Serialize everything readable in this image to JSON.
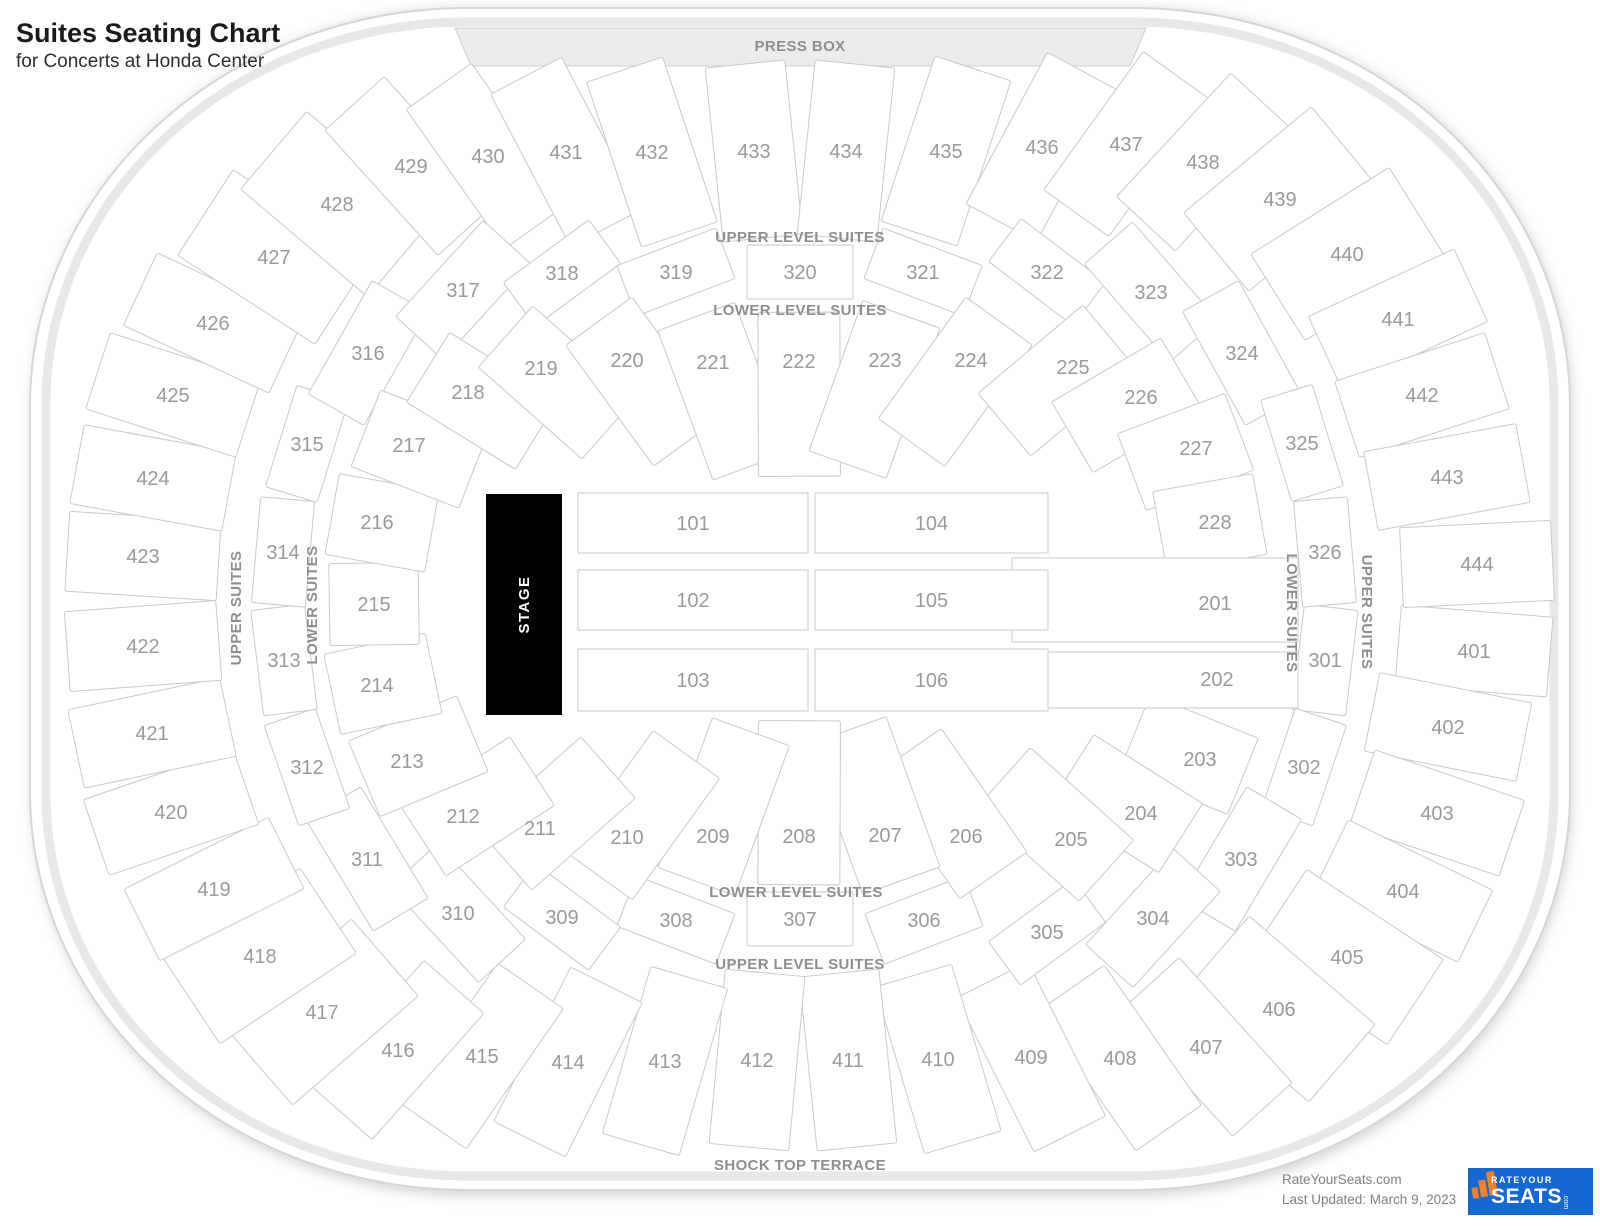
{
  "title": {
    "heading": "Suites Seating Chart",
    "subheading": "for Concerts at Honda Center"
  },
  "credits": {
    "site": "RateYourSeats.com",
    "updated": "Last Updated: March 9, 2023"
  },
  "logo": {
    "line1": "RATEYOUR",
    "line2": "SEATS",
    "suffix": ".com"
  },
  "colors": {
    "section_fill": "#ffffff",
    "section_border": "#c9c9c9",
    "number_text": "#9a9a9a",
    "ring_label_text": "#8e8e8e",
    "press_box_fill": "#ececec",
    "stage_fill": "#000000",
    "stage_text": "#ffffff",
    "logo_blue": "#1567d2",
    "logo_orange": "#f58025",
    "outer_rim": "#e3e3e3"
  },
  "arena": {
    "center": {
      "x": 800,
      "y": 597
    },
    "press_box": {
      "label": "PRESS BOX",
      "x": 800,
      "y": 51
    },
    "stage": {
      "label": "STAGE",
      "x": 486,
      "y": 494,
      "w": 76,
      "h": 221
    },
    "ring_labels": [
      {
        "name": "upper-level-suites-top",
        "text": "UPPER LEVEL SUITES",
        "x": 800,
        "y": 242,
        "rot": 0
      },
      {
        "name": "lower-level-suites-top",
        "text": "LOWER LEVEL SUITES",
        "x": 800,
        "y": 315,
        "rot": 0
      },
      {
        "name": "lower-level-suites-bottom",
        "text": "LOWER LEVEL SUITES",
        "x": 796,
        "y": 897,
        "rot": 0
      },
      {
        "name": "upper-level-suites-bottom",
        "text": "UPPER LEVEL SUITES",
        "x": 800,
        "y": 969,
        "rot": 0
      },
      {
        "name": "shock-top-terrace",
        "text": "SHOCK TOP TERRACE",
        "x": 800,
        "y": 1170,
        "rot": 0
      },
      {
        "name": "upper-suites-left",
        "text": "UPPER SUITES",
        "x": 241,
        "y": 608,
        "rot": -90
      },
      {
        "name": "lower-suites-left",
        "text": "LOWER SUITES",
        "x": 317,
        "y": 605,
        "rot": -90
      },
      {
        "name": "lower-suites-right",
        "text": "LOWER SUITES",
        "x": 1287,
        "y": 613,
        "rot": 90
      },
      {
        "name": "upper-suites-right",
        "text": "UPPER SUITES",
        "x": 1362,
        "y": 612,
        "rot": 90
      }
    ],
    "floor_sections": [
      {
        "id": "101",
        "x": 578,
        "y": 493,
        "w": 230,
        "h": 60
      },
      {
        "id": "102",
        "x": 578,
        "y": 570,
        "w": 230,
        "h": 60
      },
      {
        "id": "103",
        "x": 578,
        "y": 649,
        "w": 230,
        "h": 62
      },
      {
        "id": "104",
        "x": 815,
        "y": 493,
        "w": 233,
        "h": 60
      },
      {
        "id": "105",
        "x": 815,
        "y": 570,
        "w": 233,
        "h": 60
      },
      {
        "id": "106",
        "x": 815,
        "y": 649,
        "w": 233,
        "h": 62
      }
    ],
    "special_sections": [
      {
        "id": "201",
        "x": 1012,
        "y": 558,
        "w": 286,
        "h": 84,
        "lx": 1215,
        "ly": 603
      },
      {
        "id": "202",
        "x": 1040,
        "y": 652,
        "w": 258,
        "h": 56,
        "lx": 1217,
        "ly": 679
      }
    ],
    "rings": {
      "inner": {
        "sections": [
          {
            "id": "203",
            "x": 1200,
            "y": 759
          },
          {
            "id": "204",
            "x": 1141,
            "y": 813
          },
          {
            "id": "205",
            "x": 1071,
            "y": 839
          },
          {
            "id": "206",
            "x": 966,
            "y": 836
          },
          {
            "id": "207",
            "x": 885,
            "y": 835
          },
          {
            "id": "208",
            "x": 799,
            "y": 836
          },
          {
            "id": "209",
            "x": 713,
            "y": 836
          },
          {
            "id": "210",
            "x": 627,
            "y": 837
          },
          {
            "id": "211",
            "x": 540,
            "y": 828
          },
          {
            "id": "212",
            "x": 463,
            "y": 816
          },
          {
            "id": "213",
            "x": 407,
            "y": 761
          },
          {
            "id": "214",
            "x": 377,
            "y": 685
          },
          {
            "id": "215",
            "x": 374,
            "y": 604
          },
          {
            "id": "216",
            "x": 377,
            "y": 522
          },
          {
            "id": "217",
            "x": 409,
            "y": 445
          },
          {
            "id": "218",
            "x": 468,
            "y": 392
          },
          {
            "id": "219",
            "x": 541,
            "y": 368
          },
          {
            "id": "220",
            "x": 627,
            "y": 360
          },
          {
            "id": "221",
            "x": 713,
            "y": 362
          },
          {
            "id": "222",
            "x": 799,
            "y": 361
          },
          {
            "id": "223",
            "x": 885,
            "y": 360
          },
          {
            "id": "224",
            "x": 971,
            "y": 360
          },
          {
            "id": "225",
            "x": 1073,
            "y": 367
          },
          {
            "id": "226",
            "x": 1141,
            "y": 397
          },
          {
            "id": "227",
            "x": 1196,
            "y": 448
          },
          {
            "id": "228",
            "x": 1215,
            "y": 522
          }
        ]
      },
      "middle": {
        "corners": [
          "303",
          "304",
          "310",
          "311",
          "316",
          "317",
          "323",
          "324"
        ],
        "sections": [
          {
            "id": "301",
            "x": 1325,
            "y": 660
          },
          {
            "id": "302",
            "x": 1304,
            "y": 767
          },
          {
            "id": "303",
            "x": 1241,
            "y": 859
          },
          {
            "id": "304",
            "x": 1153,
            "y": 918
          },
          {
            "id": "305",
            "x": 1047,
            "y": 932
          },
          {
            "id": "306",
            "x": 924,
            "y": 920
          },
          {
            "id": "307",
            "x": 800,
            "y": 919
          },
          {
            "id": "308",
            "x": 676,
            "y": 920
          },
          {
            "id": "309",
            "x": 562,
            "y": 917
          },
          {
            "id": "310",
            "x": 458,
            "y": 913
          },
          {
            "id": "311",
            "x": 367,
            "y": 859
          },
          {
            "id": "312",
            "x": 307,
            "y": 767
          },
          {
            "id": "313",
            "x": 284,
            "y": 660
          },
          {
            "id": "314",
            "x": 283,
            "y": 552
          },
          {
            "id": "315",
            "x": 307,
            "y": 444
          },
          {
            "id": "316",
            "x": 368,
            "y": 353
          },
          {
            "id": "317",
            "x": 463,
            "y": 290
          },
          {
            "id": "318",
            "x": 562,
            "y": 273
          },
          {
            "id": "319",
            "x": 676,
            "y": 272
          },
          {
            "id": "320",
            "x": 800,
            "y": 272
          },
          {
            "id": "321",
            "x": 923,
            "y": 272
          },
          {
            "id": "322",
            "x": 1047,
            "y": 272
          },
          {
            "id": "323",
            "x": 1151,
            "y": 292
          },
          {
            "id": "324",
            "x": 1242,
            "y": 353
          },
          {
            "id": "325",
            "x": 1302,
            "y": 443
          },
          {
            "id": "326",
            "x": 1325,
            "y": 552
          }
        ]
      },
      "outer": {
        "corners": [
          "405",
          "406",
          "417",
          "418",
          "427",
          "428",
          "439",
          "440"
        ],
        "sections": [
          {
            "id": "401",
            "x": 1474,
            "y": 651
          },
          {
            "id": "402",
            "x": 1448,
            "y": 727
          },
          {
            "id": "403",
            "x": 1437,
            "y": 813
          },
          {
            "id": "404",
            "x": 1403,
            "y": 891
          },
          {
            "id": "405",
            "x": 1347,
            "y": 957
          },
          {
            "id": "406",
            "x": 1279,
            "y": 1009
          },
          {
            "id": "407",
            "x": 1206,
            "y": 1047
          },
          {
            "id": "408",
            "x": 1120,
            "y": 1058
          },
          {
            "id": "409",
            "x": 1031,
            "y": 1057
          },
          {
            "id": "410",
            "x": 938,
            "y": 1059
          },
          {
            "id": "411",
            "x": 848,
            "y": 1060
          },
          {
            "id": "412",
            "x": 757,
            "y": 1060
          },
          {
            "id": "413",
            "x": 665,
            "y": 1061
          },
          {
            "id": "414",
            "x": 568,
            "y": 1062
          },
          {
            "id": "415",
            "x": 482,
            "y": 1056
          },
          {
            "id": "416",
            "x": 398,
            "y": 1050
          },
          {
            "id": "417",
            "x": 322,
            "y": 1012
          },
          {
            "id": "418",
            "x": 260,
            "y": 956
          },
          {
            "id": "419",
            "x": 214,
            "y": 889
          },
          {
            "id": "420",
            "x": 171,
            "y": 812
          },
          {
            "id": "421",
            "x": 152,
            "y": 733
          },
          {
            "id": "422",
            "x": 143,
            "y": 646
          },
          {
            "id": "423",
            "x": 143,
            "y": 556
          },
          {
            "id": "424",
            "x": 153,
            "y": 478
          },
          {
            "id": "425",
            "x": 173,
            "y": 395
          },
          {
            "id": "426",
            "x": 213,
            "y": 323
          },
          {
            "id": "427",
            "x": 274,
            "y": 257
          },
          {
            "id": "428",
            "x": 337,
            "y": 204
          },
          {
            "id": "429",
            "x": 411,
            "y": 166
          },
          {
            "id": "430",
            "x": 488,
            "y": 156
          },
          {
            "id": "431",
            "x": 566,
            "y": 152
          },
          {
            "id": "432",
            "x": 652,
            "y": 152
          },
          {
            "id": "433",
            "x": 754,
            "y": 151
          },
          {
            "id": "434",
            "x": 846,
            "y": 151
          },
          {
            "id": "435",
            "x": 946,
            "y": 151
          },
          {
            "id": "436",
            "x": 1042,
            "y": 147
          },
          {
            "id": "437",
            "x": 1126,
            "y": 144
          },
          {
            "id": "438",
            "x": 1203,
            "y": 162
          },
          {
            "id": "439",
            "x": 1280,
            "y": 199
          },
          {
            "id": "440",
            "x": 1347,
            "y": 254
          },
          {
            "id": "441",
            "x": 1398,
            "y": 319
          },
          {
            "id": "442",
            "x": 1422,
            "y": 395
          },
          {
            "id": "443",
            "x": 1447,
            "y": 477
          },
          {
            "id": "444",
            "x": 1477,
            "y": 564
          }
        ]
      }
    }
  }
}
